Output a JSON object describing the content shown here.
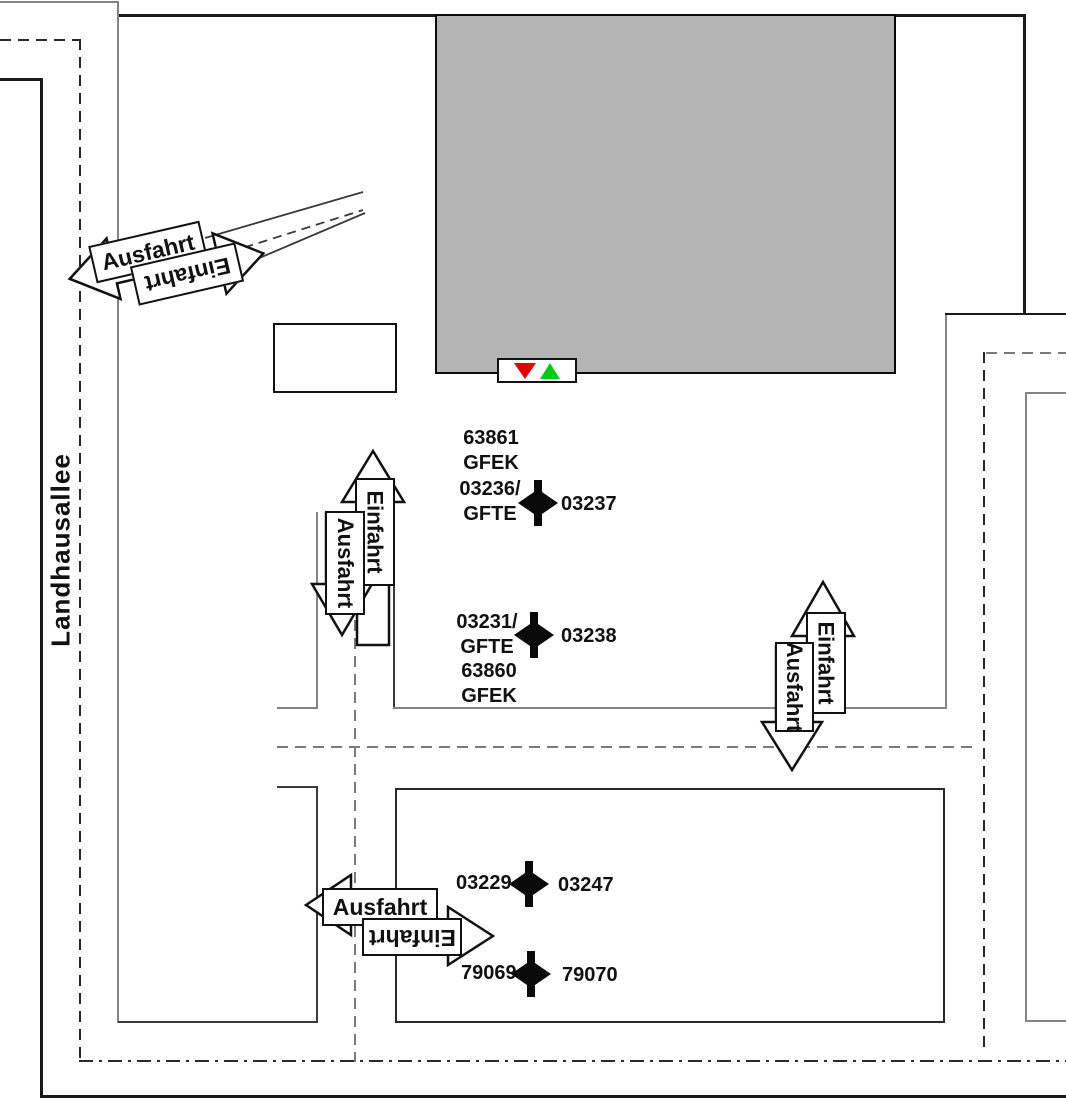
{
  "street": {
    "label": "Landhausallee"
  },
  "entrances": {
    "top_left": {
      "exit": "Ausfahrt",
      "entry": "Einfahrt"
    },
    "mid_left": {
      "entry": "Einfahrt",
      "exit": "Ausfahrt"
    },
    "right": {
      "entry": "Einfahrt",
      "exit": "Ausfahrt"
    },
    "bottom": {
      "exit": "Ausfahrt",
      "entry": "Einfahrt"
    }
  },
  "gates": {
    "upper_block": {
      "line1": "63861",
      "line2": "GFEK"
    },
    "gate1": {
      "left_line1": "03236/",
      "left_line2": "GFTE",
      "right": "03237"
    },
    "gate2": {
      "left_line1": "03231/",
      "left_line2": "GFTE",
      "right": "03238"
    },
    "lower_block": {
      "line1": "63860",
      "line2": "GFEK"
    },
    "gate3": {
      "left": "03229",
      "right": "03247"
    },
    "gate4": {
      "left": "79069",
      "right": "79070"
    }
  },
  "signal": {
    "red": "#e60000",
    "green": "#00cc11"
  },
  "colors": {
    "building_fill": "#b4b4b4",
    "line_dark": "#1a1a1a",
    "line_gray": "#848484"
  }
}
